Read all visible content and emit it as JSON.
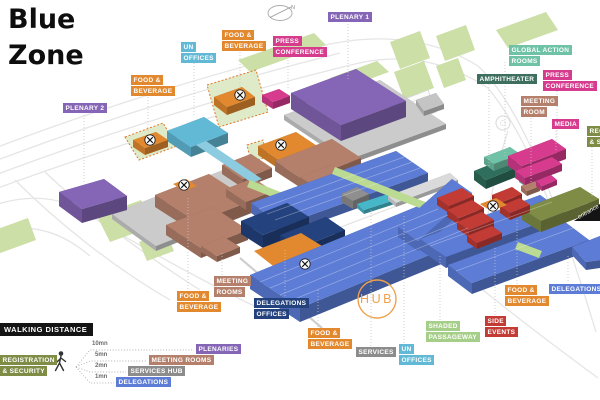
{
  "title": {
    "line1": "Blue",
    "line2": "Zone"
  },
  "palette": {
    "purple": "#8565B5",
    "orange": "#E2892F",
    "lightblue": "#62B9D6",
    "pink": "#D63B8E",
    "teal": "#6FC2A5",
    "darkgreen": "#3E6F5E",
    "brown": "#B5806B",
    "olive": "#7F8C45",
    "blue": "#5C7CD6",
    "navy": "#24427E",
    "red": "#C23B35",
    "gray": "#8C8C8C",
    "lightgreen": "#A5CE89",
    "black": "#1A1A1A",
    "cyan": "#45B7C9",
    "platform": "#CBCBCB",
    "lightbar": "#DADADA",
    "darkgray": "#8F8F8F",
    "tealDark": "#2F6E5C",
    "hubRing": "#F0A14B",
    "roadLine": "#E5E5E5",
    "greenPatch": "#CBDFA6",
    "walkwayGreen": "#BBDA92",
    "dashedZoneFill": "#DFEBC8",
    "dashedZoneStroke": "#E2772B"
  },
  "map": {
    "hub_label": "HUB",
    "entrance_label": "entrance",
    "compass_label": "N",
    "labels": [
      {
        "id": "plenary-2",
        "lines": [
          "PLENARY 2"
        ],
        "color": "purple",
        "x": 63,
        "y": 103
      },
      {
        "id": "food-beverage-left",
        "lines": [
          "FOOD &",
          "BEVERAGE"
        ],
        "color": "orange",
        "x": 131,
        "y": 75
      },
      {
        "id": "un-offices-top",
        "lines": [
          "UN",
          "OFFICES"
        ],
        "color": "lightblue",
        "x": 181,
        "y": 42
      },
      {
        "id": "food-beverage-top",
        "lines": [
          "FOOD &",
          "BEVERAGE"
        ],
        "color": "orange",
        "x": 222,
        "y": 30
      },
      {
        "id": "press-conference-top",
        "lines": [
          "PRESS",
          "CONFERENCE"
        ],
        "color": "pink",
        "x": 273,
        "y": 36
      },
      {
        "id": "plenary-1",
        "lines": [
          "PLENARY 1"
        ],
        "color": "purple",
        "x": 328,
        "y": 12
      },
      {
        "id": "global-action-rooms",
        "lines": [
          "GLOBAL ACTION",
          "ROOMS"
        ],
        "color": "teal",
        "x": 509,
        "y": 45
      },
      {
        "id": "amphitheater",
        "lines": [
          "AMPHITHEATER"
        ],
        "color": "darkgreen",
        "x": 477,
        "y": 74
      },
      {
        "id": "press-conference-right",
        "lines": [
          "PRESS",
          "CONFERENCE"
        ],
        "color": "pink",
        "x": 543,
        "y": 70
      },
      {
        "id": "meeting-room",
        "lines": [
          "MEETING",
          "ROOM"
        ],
        "color": "brown",
        "x": 521,
        "y": 96
      },
      {
        "id": "media",
        "lines": [
          "MEDIA"
        ],
        "color": "pink",
        "x": 552,
        "y": 119
      },
      {
        "id": "registration-security",
        "lines": [
          "REGISTRATION",
          "& SECURITY"
        ],
        "color": "olive",
        "x": 587,
        "y": 126
      },
      {
        "id": "meeting-rooms-bottom",
        "lines": [
          "MEETING",
          "ROOMS"
        ],
        "color": "brown",
        "x": 214,
        "y": 276
      },
      {
        "id": "food-beverage-bottom-left",
        "lines": [
          "FOOD &",
          "BEVERAGE"
        ],
        "color": "orange",
        "x": 177,
        "y": 291
      },
      {
        "id": "delegations-offices",
        "lines": [
          "DELEGATIONS",
          "OFFICES"
        ],
        "color": "navy",
        "x": 254,
        "y": 298
      },
      {
        "id": "food-beverage-bottom-center",
        "lines": [
          "FOOD &",
          "BEVERAGE"
        ],
        "color": "orange",
        "x": 308,
        "y": 328
      },
      {
        "id": "services",
        "lines": [
          "SERVICES"
        ],
        "color": "gray",
        "x": 356,
        "y": 347
      },
      {
        "id": "un-offices-bottom",
        "lines": [
          "UN",
          "OFFICES"
        ],
        "color": "lightblue",
        "x": 399,
        "y": 344
      },
      {
        "id": "shaded-passageway",
        "lines": [
          "SHADED",
          "PASSAGEWAY"
        ],
        "color": "lightgreen",
        "x": 426,
        "y": 321
      },
      {
        "id": "side-events",
        "lines": [
          "SIDE",
          "EVENTS"
        ],
        "color": "red",
        "x": 485,
        "y": 316
      },
      {
        "id": "food-beverage-bottom-right",
        "lines": [
          "FOOD &",
          "BEVERAGE"
        ],
        "color": "orange",
        "x": 505,
        "y": 285
      },
      {
        "id": "delegations-right",
        "lines": [
          "DELEGATIONS"
        ],
        "color": "blue",
        "x": 549,
        "y": 284
      }
    ]
  },
  "legend": {
    "title": "WALKING DISTANCE",
    "origin_lines": [
      "REGISTRATION",
      "& SECURITY"
    ],
    "origin_color": "olive",
    "rows": [
      {
        "time": "10mn",
        "destination": "PLENARIES",
        "color": "purple"
      },
      {
        "time": "5mn",
        "destination": "MEETING ROOMS",
        "color": "brown"
      },
      {
        "time": "2mn",
        "destination": "SERVICES HUB",
        "color": "gray"
      },
      {
        "time": "1mn",
        "destination": "DELEGATIONS",
        "color": "blue"
      }
    ]
  }
}
